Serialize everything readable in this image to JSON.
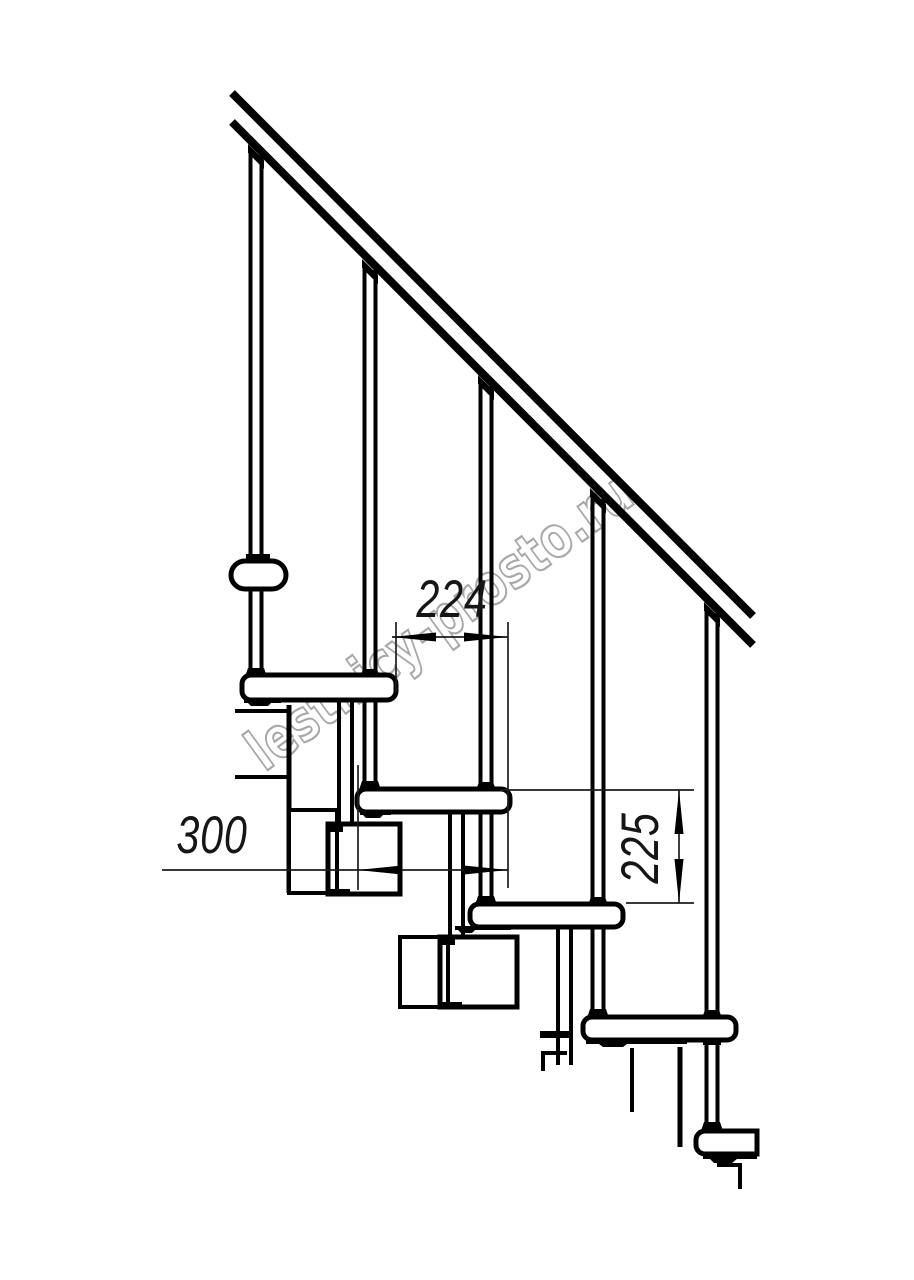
{
  "drawing": {
    "background_color": "#ffffff",
    "ink_color": "#000000",
    "thin_line_color": "#1c1c1c",
    "watermark": {
      "text": "lestnicy-prosto.ru",
      "color": "#a8a8a8"
    },
    "dimensions": {
      "going": {
        "value": "224",
        "orientation": "horizontal"
      },
      "tread_depth": {
        "value": "300",
        "orientation": "horizontal"
      },
      "rise": {
        "value": "225",
        "orientation": "vertical"
      }
    },
    "structure": {
      "balusters": 5,
      "treads": 5,
      "handrail": "diagonal"
    }
  }
}
